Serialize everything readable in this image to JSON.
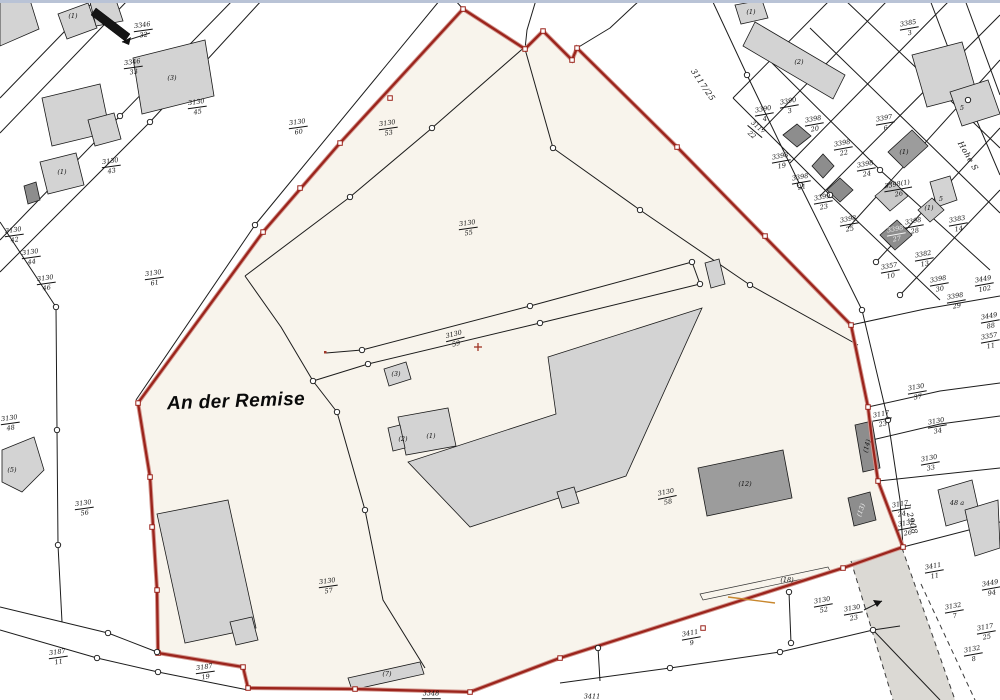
{
  "map": {
    "area_label": "An der Remise",
    "street_labels": [
      {
        "t": "3117/25",
        "x": 703,
        "y": 85,
        "r": 56
      },
      {
        "t": "Hohe S",
        "x": 968,
        "y": 156,
        "r": 60
      },
      {
        "t": "L 2908",
        "x": 911,
        "y": 519,
        "r": 75
      }
    ],
    "parcel_labels": [
      {
        "n": "3346",
        "d": "32",
        "x": 143,
        "y": 30,
        "r": -8
      },
      {
        "n": "3346",
        "d": "33",
        "x": 133,
        "y": 67,
        "r": -8
      },
      {
        "n": "3130",
        "d": "45",
        "x": 197,
        "y": 107,
        "r": -8
      },
      {
        "n": "3130",
        "d": "60",
        "x": 298,
        "y": 127,
        "r": -8
      },
      {
        "n": "3130",
        "d": "43",
        "x": 111,
        "y": 166,
        "r": -8
      },
      {
        "n": "3130",
        "d": "42",
        "x": 14,
        "y": 235,
        "r": -8
      },
      {
        "n": "3130",
        "d": "44",
        "x": 31,
        "y": 257,
        "r": -8
      },
      {
        "n": "3130",
        "d": "46",
        "x": 46,
        "y": 283,
        "r": -8
      },
      {
        "n": "3130",
        "d": "61",
        "x": 154,
        "y": 278,
        "r": -8
      },
      {
        "n": "3130",
        "d": "48",
        "x": 10,
        "y": 423,
        "r": -8
      },
      {
        "n": "3130",
        "d": "56",
        "x": 84,
        "y": 508,
        "r": -8
      },
      {
        "n": "3187",
        "d": "11",
        "x": 58,
        "y": 657,
        "r": -8
      },
      {
        "n": "3187",
        "d": "19",
        "x": 205,
        "y": 672,
        "r": -8
      },
      {
        "n": "3130",
        "d": "53",
        "x": 388,
        "y": 128,
        "r": -8
      },
      {
        "n": "3130",
        "d": "55",
        "x": 468,
        "y": 228,
        "r": -8
      },
      {
        "n": "3130",
        "d": "59",
        "x": 455,
        "y": 339,
        "r": -14
      },
      {
        "n": "3130",
        "d": "57",
        "x": 328,
        "y": 586,
        "r": -8
      },
      {
        "n": "3130",
        "d": "58",
        "x": 667,
        "y": 497,
        "r": -12
      },
      {
        "n": "3130",
        "d": "52",
        "x": 823,
        "y": 605,
        "r": -10
      },
      {
        "n": "3411",
        "d": "9",
        "x": 691,
        "y": 638,
        "r": -10
      },
      {
        "n": "3130",
        "d": "23",
        "x": 853,
        "y": 613,
        "r": -10
      },
      {
        "n": "3348",
        "d": "",
        "x": 431,
        "y": 694,
        "r": 0
      },
      {
        "n": "3411",
        "d": "",
        "x": 592,
        "y": 697,
        "r": 0
      },
      {
        "n": "3117",
        "d": "22",
        "x": 755,
        "y": 131,
        "r": 40
      },
      {
        "n": "3390",
        "d": "4",
        "x": 764,
        "y": 114,
        "r": -10
      },
      {
        "n": "3390",
        "d": "3",
        "x": 789,
        "y": 106,
        "r": -10
      },
      {
        "n": "3398",
        "d": "20",
        "x": 814,
        "y": 124,
        "r": -10
      },
      {
        "n": "3398",
        "d": "19",
        "x": 781,
        "y": 161,
        "r": -10
      },
      {
        "n": "3398",
        "d": "21",
        "x": 801,
        "y": 182,
        "r": -10
      },
      {
        "n": "3399",
        "d": "23",
        "x": 823,
        "y": 202,
        "r": -10
      },
      {
        "n": "3398",
        "d": "22",
        "x": 843,
        "y": 148,
        "r": -10
      },
      {
        "n": "3398",
        "d": "24",
        "x": 866,
        "y": 169,
        "r": -10
      },
      {
        "n": "3397",
        "d": "6",
        "x": 885,
        "y": 123,
        "r": -10
      },
      {
        "n": "3385",
        "d": "3",
        "x": 909,
        "y": 28,
        "r": -10
      },
      {
        "n": "3398(1)",
        "d": "26",
        "x": 898,
        "y": 189,
        "r": -10
      },
      {
        "n": "3398",
        "d": "25",
        "x": 849,
        "y": 224,
        "r": -10
      },
      {
        "n": "3398",
        "d": "28",
        "x": 914,
        "y": 226,
        "r": -10
      },
      {
        "n": "3398",
        "d": "27",
        "x": 896,
        "y": 234,
        "r": -10,
        "c": "#f2f2f2"
      },
      {
        "n": "3382",
        "d": "13",
        "x": 924,
        "y": 259,
        "r": -10
      },
      {
        "n": "3383",
        "d": "14",
        "x": 958,
        "y": 224,
        "r": -10
      },
      {
        "n": "3398",
        "d": "30",
        "x": 939,
        "y": 284,
        "r": -10
      },
      {
        "n": "3449",
        "d": "102",
        "x": 984,
        "y": 284,
        "r": -10
      },
      {
        "n": "3398",
        "d": "29",
        "x": 956,
        "y": 301,
        "r": -10
      },
      {
        "n": "3357",
        "d": "10",
        "x": 890,
        "y": 271,
        "r": -10
      },
      {
        "n": "3449",
        "d": "88",
        "x": 990,
        "y": 321,
        "r": -10
      },
      {
        "n": "3357",
        "d": "11",
        "x": 990,
        "y": 341,
        "r": -10
      },
      {
        "n": "3130",
        "d": "37",
        "x": 917,
        "y": 392,
        "r": -10
      },
      {
        "n": "3117",
        "d": "23",
        "x": 882,
        "y": 419,
        "r": -10
      },
      {
        "n": "3130",
        "d": "34",
        "x": 937,
        "y": 426,
        "r": -10
      },
      {
        "n": "3130",
        "d": "33",
        "x": 930,
        "y": 463,
        "r": -10
      },
      {
        "n": "3117",
        "d": "24",
        "x": 901,
        "y": 509,
        "r": -10
      },
      {
        "n": "3132",
        "d": "26",
        "x": 907,
        "y": 528,
        "r": -10
      },
      {
        "n": "3411",
        "d": "11",
        "x": 934,
        "y": 571,
        "r": -10
      },
      {
        "n": "3449",
        "d": "94",
        "x": 991,
        "y": 588,
        "r": -10
      },
      {
        "n": "3132",
        "d": "7",
        "x": 954,
        "y": 611,
        "r": -10
      },
      {
        "n": "3117",
        "d": "25",
        "x": 986,
        "y": 632,
        "r": -10
      },
      {
        "n": "3132",
        "d": "8",
        "x": 973,
        "y": 654,
        "r": -10
      }
    ],
    "building_labels": [
      {
        "t": "(1)",
        "x": 73,
        "y": 16
      },
      {
        "t": "(3)",
        "x": 172,
        "y": 78
      },
      {
        "t": "(1)",
        "x": 62,
        "y": 172
      },
      {
        "t": "(5)",
        "x": 12,
        "y": 470
      },
      {
        "t": "(3)",
        "x": 396,
        "y": 374
      },
      {
        "t": "(2)",
        "x": 403,
        "y": 439
      },
      {
        "t": "(1)",
        "x": 431,
        "y": 436
      },
      {
        "t": "(12)",
        "x": 745,
        "y": 484
      },
      {
        "t": "(14)",
        "x": 867,
        "y": 446,
        "r": -75
      },
      {
        "t": "(13)",
        "x": 861,
        "y": 510,
        "r": -70,
        "c": "#f0f0f0"
      },
      {
        "t": "(7)",
        "x": 387,
        "y": 674
      },
      {
        "t": "(2)",
        "x": 799,
        "y": 62
      },
      {
        "t": "(1)",
        "x": 751,
        "y": 12
      },
      {
        "t": "(18)",
        "x": 787,
        "y": 580
      },
      {
        "t": "(1)",
        "x": 904,
        "y": 152
      },
      {
        "t": "(1)",
        "x": 929,
        "y": 208
      },
      {
        "t": "5",
        "x": 962,
        "y": 108
      },
      {
        "t": "5",
        "x": 941,
        "y": 199
      },
      {
        "t": "48 a",
        "x": 957,
        "y": 503
      }
    ],
    "colors": {
      "boundary_red": "#9b241c",
      "building_gray": "#d3d3d3",
      "building_dark": "#8d8d8d",
      "area_fill": "#f8f4ec",
      "road_fill": "#dbd9d4",
      "chrome_strip": "#b9c3d6"
    }
  }
}
